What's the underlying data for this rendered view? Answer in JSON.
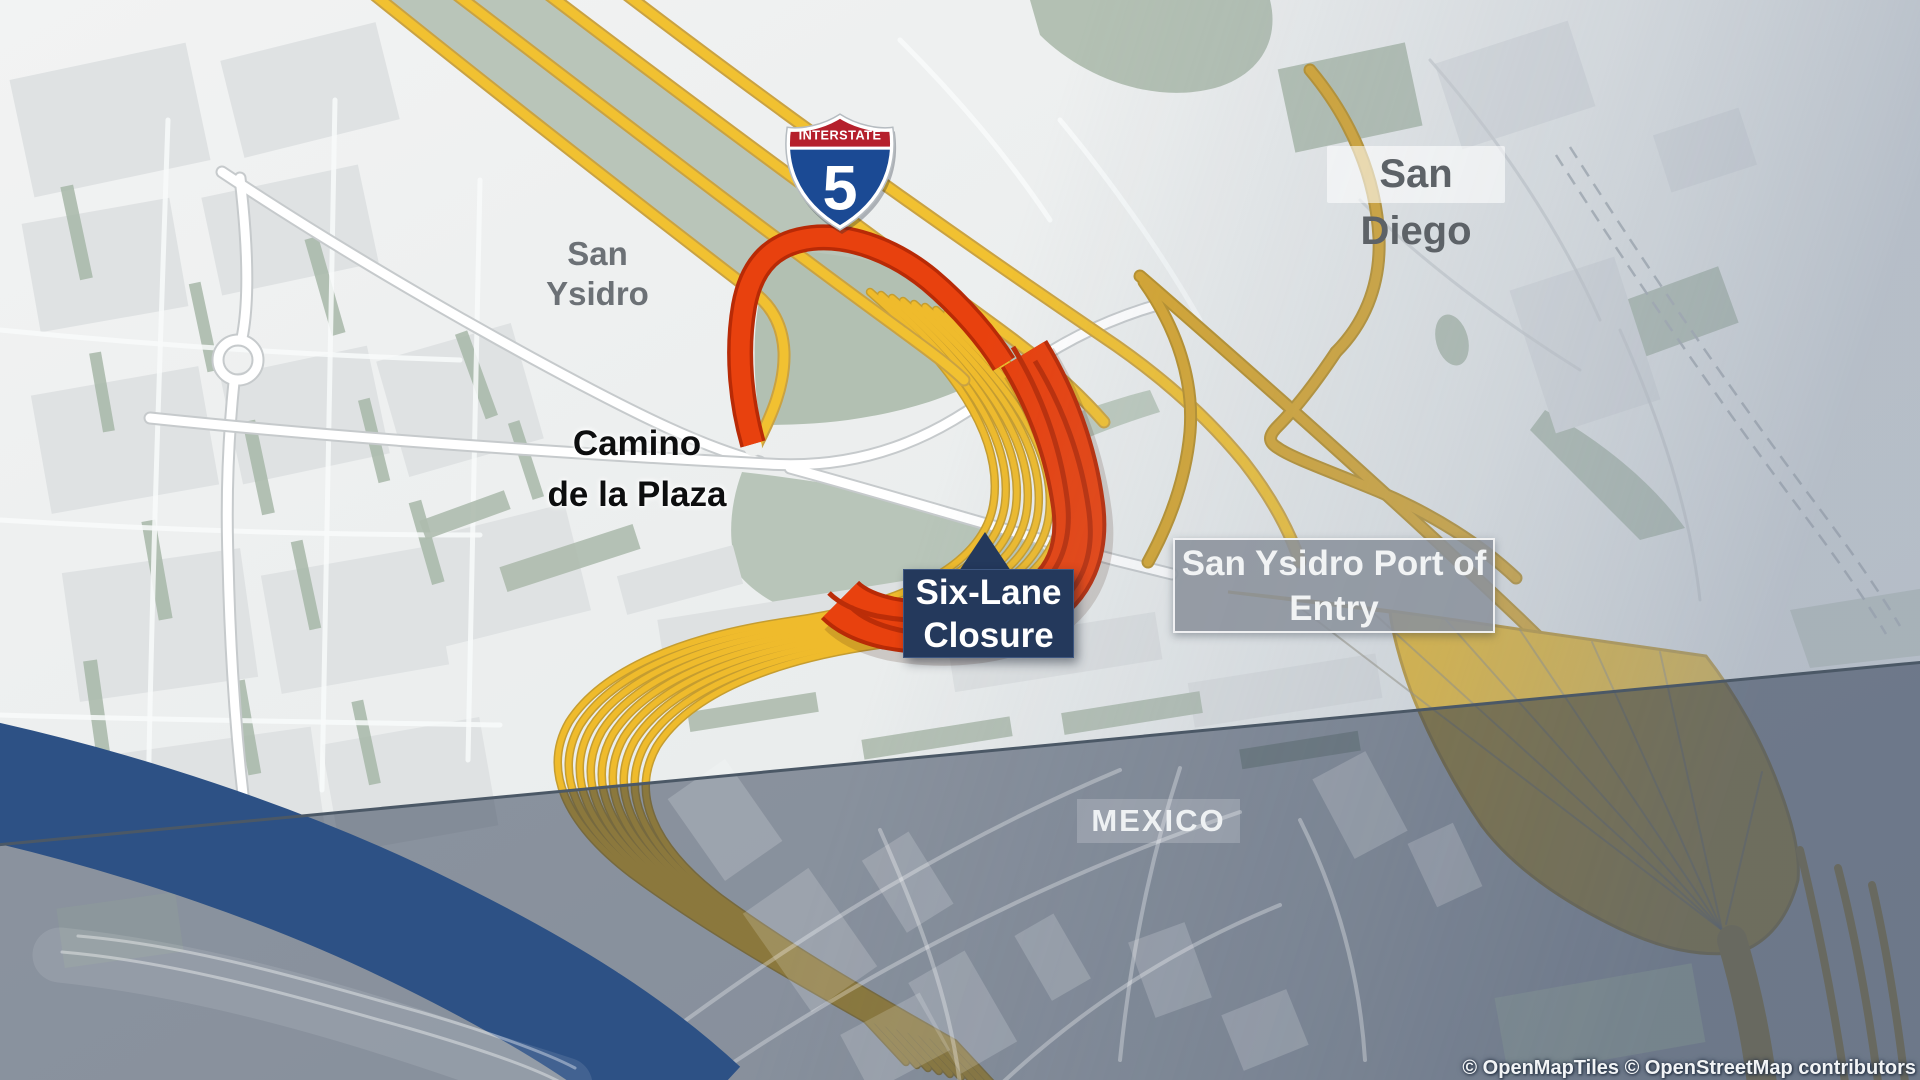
{
  "map": {
    "labels": {
      "san_diego": "San Diego",
      "san_ysidro_line1": "San",
      "san_ysidro_line2": "Ysidro",
      "camino_line1": "Camino",
      "camino_line2": "de la Plaza",
      "closure_line1": "Six-Lane",
      "closure_line2": "Closure",
      "port_line1": "San Ysidro Port of",
      "port_line2": "Entry",
      "mexico": "MEXICO"
    },
    "shield": {
      "top": "INTERSTATE",
      "number": "5"
    },
    "attribution": "© OpenMapTiles © OpenStreetMap contributors",
    "colors": {
      "closure_red": "#e8410e",
      "closure_red_dark": "#bb2d08",
      "freeway_yellow": "#f1c131",
      "gold_road": "#d6a52e",
      "callout_navy": "#24395c",
      "river_blue": "#2d5185",
      "mexico_overlay": "rgba(40,54,78,0.5)",
      "map_green": "#b2c0b2",
      "shield_blue": "#1b4a94",
      "shield_red": "#b5202c"
    }
  }
}
